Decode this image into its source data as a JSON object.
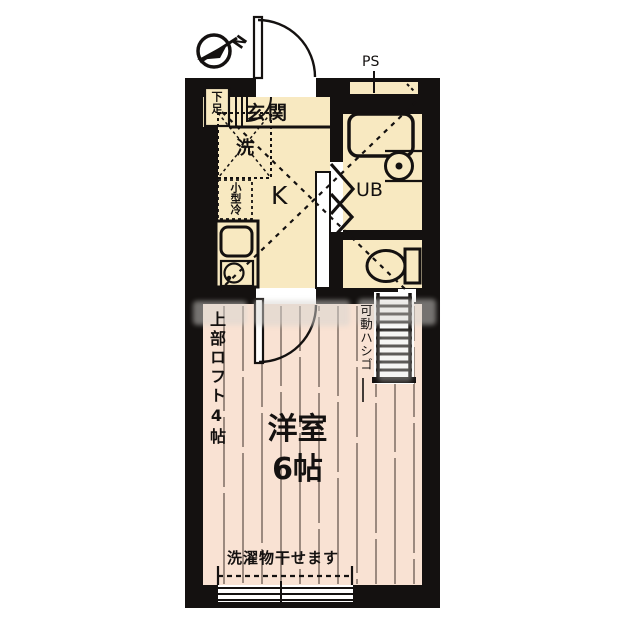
{
  "plan": {
    "title": "1K apartment floor plan with loft",
    "labels": {
      "compass_north": "N",
      "pipe_space": "PS",
      "entrance": "玄関",
      "shoe_cabinet": "下足",
      "washer": "洗",
      "small_fridge": "小型冷",
      "kitchen": "K",
      "unit_bath": "UB",
      "upper_loft": "上部ロフト4帖",
      "movable_ladder": "可動ハシゴ",
      "western_room": "洋室",
      "western_room_size": "6帖",
      "laundry_note": "洗濯物干せます"
    },
    "colors": {
      "wall": "#141110",
      "kitchen_floor": "#f8e9c1",
      "room_floor": "#f9e2d3",
      "plank_line": "#5f5148"
    }
  }
}
